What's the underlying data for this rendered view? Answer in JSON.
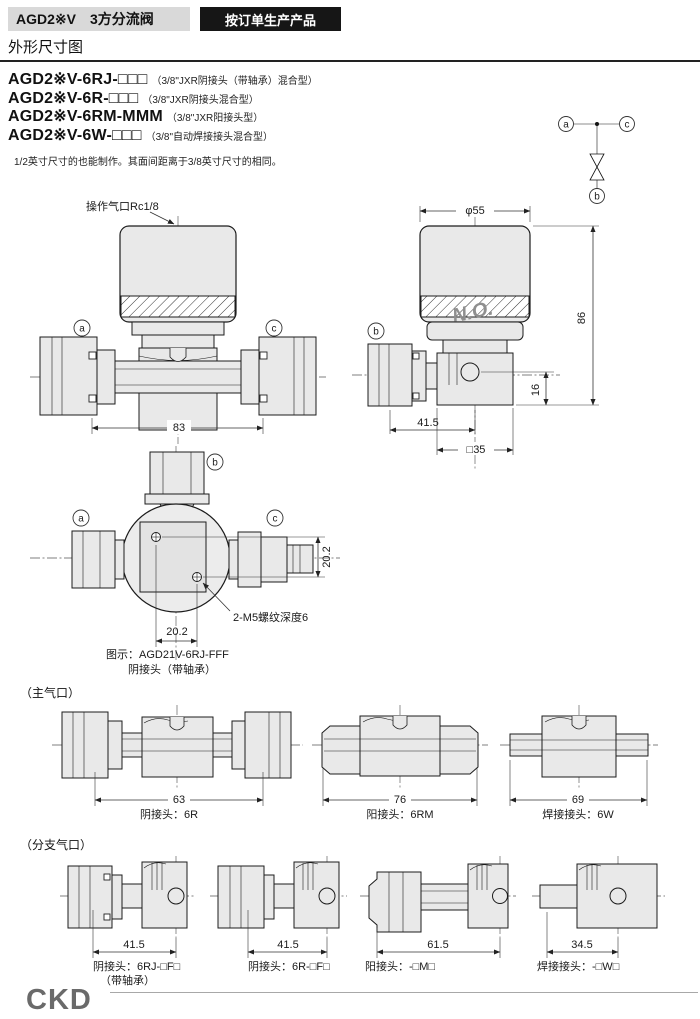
{
  "header": {
    "product_title": "AGD2※V　3方分流阀",
    "badge": "按订单生产产品",
    "section_title": "外形尺寸图"
  },
  "models": [
    {
      "code": "AGD2※V-6RJ-□□□",
      "desc": "（3/8\"JXR阴接头（带轴承）混合型）"
    },
    {
      "code": "AGD2※V-6R-□□□",
      "desc": "（3/8\"JXR阴接头混合型）"
    },
    {
      "code": "AGD2※V-6RM-MMM",
      "desc": "（3/8\"JXR阳接头型）"
    },
    {
      "code": "AGD2※V-6W-□□□",
      "desc": "（3/8\"自动焊接接头混合型）"
    }
  ],
  "note": "1/2英寸尺寸的也能制作。其面间距离于3/8英寸尺寸的相同。",
  "schematic": {
    "port_a": "a",
    "port_b": "b",
    "port_c": "c"
  },
  "front_view": {
    "pilot_port": "操作气口Rc1/8",
    "port_a": "a",
    "port_c": "c",
    "dim_width": "83"
  },
  "side_view": {
    "dim_dia": "φ55",
    "marking": "N.O.",
    "port_b": "b",
    "dim_height": "86",
    "dim_port_height": "16",
    "dim_branch": "41.5",
    "dim_square": "□35"
  },
  "top_view": {
    "port_a": "a",
    "port_b": "b",
    "port_c": "c",
    "dim_v": "20.2",
    "dim_h": "20.2",
    "thread_note": "2-M5螺纹深度6",
    "caption1": "图示：AGD21V-6RJ-FFF",
    "caption2": "阴接头（带轴承）"
  },
  "main_ports": {
    "title": "（主气口）",
    "items": [
      {
        "dim": "63",
        "label": "阴接头：6R"
      },
      {
        "dim": "76",
        "label": "阳接头：6RM"
      },
      {
        "dim": "69",
        "label": "焊接接头：6W"
      }
    ]
  },
  "branch_ports": {
    "title": "（分支气口）",
    "items": [
      {
        "dim": "41.5",
        "label": "阴接头：6RJ-□F□",
        "label2": "（带轴承）"
      },
      {
        "dim": "41.5",
        "label": "阴接头：6R-□F□",
        "label2": ""
      },
      {
        "dim": "61.5",
        "label": "阳接头：-□M□",
        "label2": ""
      },
      {
        "dim": "34.5",
        "label": "焊接接头：-□W□",
        "label2": ""
      }
    ]
  },
  "footer": {
    "logo": "CKD"
  },
  "colors": {
    "title_bg": "#d9d9d9",
    "badge_bg": "#161616",
    "drawing_fill": "#e9e9e9",
    "logo_gray": "#6a6a6a"
  }
}
